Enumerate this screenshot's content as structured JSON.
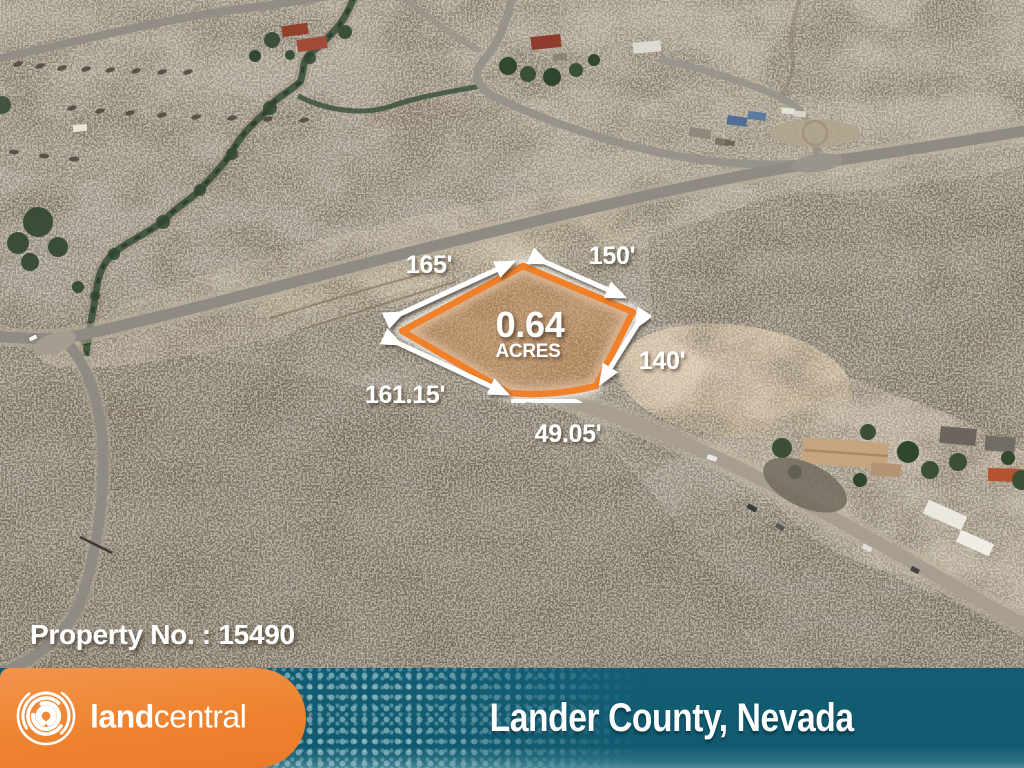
{
  "map": {
    "parcel": {
      "acreage": "0.64",
      "acreage_unit": "ACRES",
      "outline_color": "#f0802a",
      "dimensions": {
        "northwest": "165'",
        "northeast": "150'",
        "east": "140'",
        "south": "49.05'",
        "southwest": "161.15'"
      }
    },
    "property_number_label": "Property No. : 15490"
  },
  "footer": {
    "brand_bold": "land",
    "brand_light": "central",
    "location": "Lander County, Nevada",
    "panel_color": "#ee832f",
    "bar_color": "#135d74"
  },
  "icons": {
    "brand_logo": "landcentral-swirl"
  }
}
